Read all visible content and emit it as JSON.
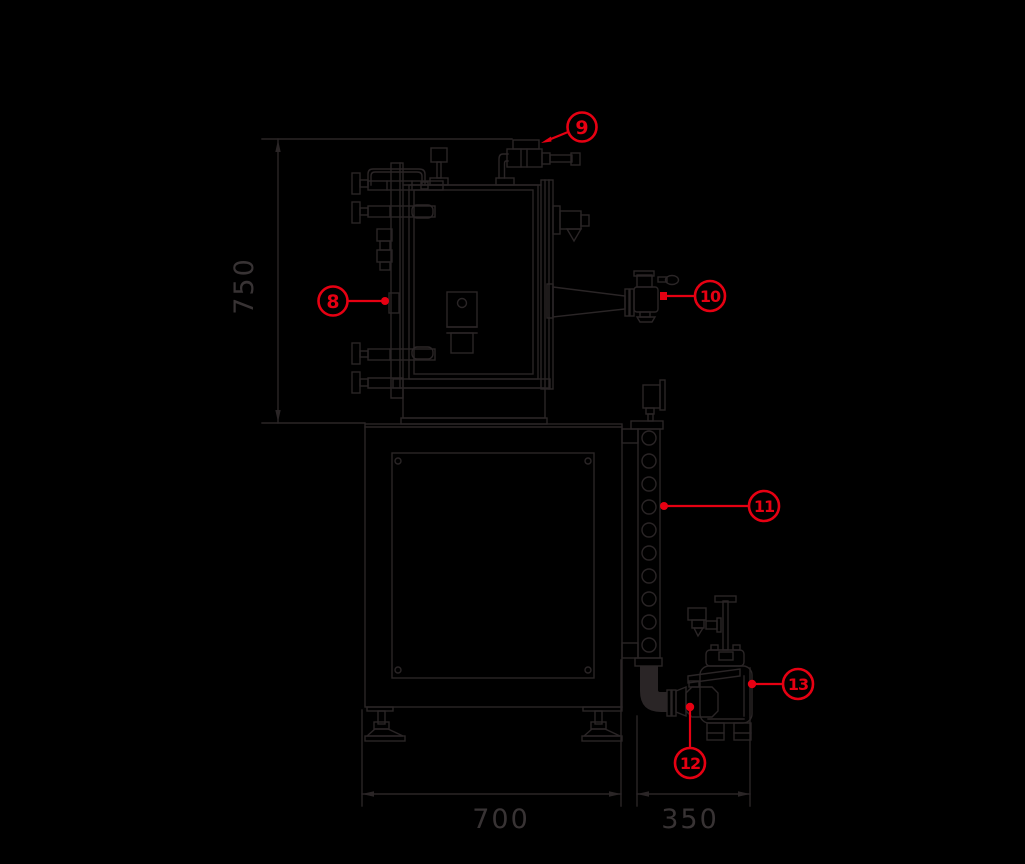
{
  "diagram": {
    "kind": "technical-drawing-side-elevation",
    "background_color": "#000000",
    "line_color": "#2a2526",
    "dim_text_color": "#383334",
    "callout_color": "#e60012",
    "dimensions": [
      {
        "label": "750",
        "axis": "vertical",
        "position": "left"
      },
      {
        "label": "700",
        "axis": "horizontal",
        "position": "bottom-left"
      },
      {
        "label": "350",
        "axis": "horizontal",
        "position": "bottom-right"
      }
    ],
    "callouts": [
      {
        "label": "8",
        "points_to": "door-hinge-column"
      },
      {
        "label": "9",
        "points_to": "top-valve"
      },
      {
        "label": "10",
        "points_to": "side-port-valve"
      },
      {
        "label": "11",
        "points_to": "perforated-support-column"
      },
      {
        "label": "12",
        "points_to": "pump-inlet-valve"
      },
      {
        "label": "13",
        "points_to": "vacuum-pump"
      }
    ]
  }
}
